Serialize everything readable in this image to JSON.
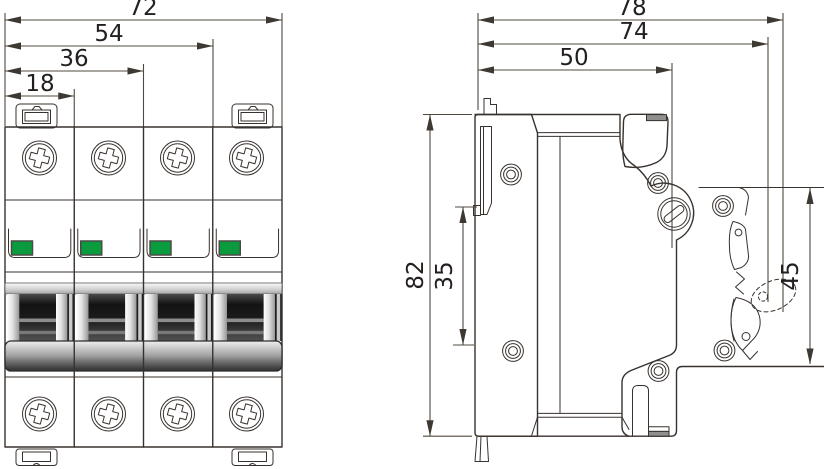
{
  "front_view": {
    "dim_total_width": "72",
    "dim_three_modules": "54",
    "dim_two_modules": "36",
    "dim_module_width": "18"
  },
  "side_view": {
    "dim_total_depth": "78",
    "dim_depth_with_latch": "74",
    "dim_body_depth": "50",
    "dim_height": "82",
    "dim_rail_slot": "35",
    "dim_front_height": "45"
  },
  "colors": {
    "line": "#38322e",
    "dimension_line": "#50483f",
    "indicator_green": "#0a9b3f",
    "metal_gray": "#8f8f8f",
    "handle_dark": "#161616"
  }
}
